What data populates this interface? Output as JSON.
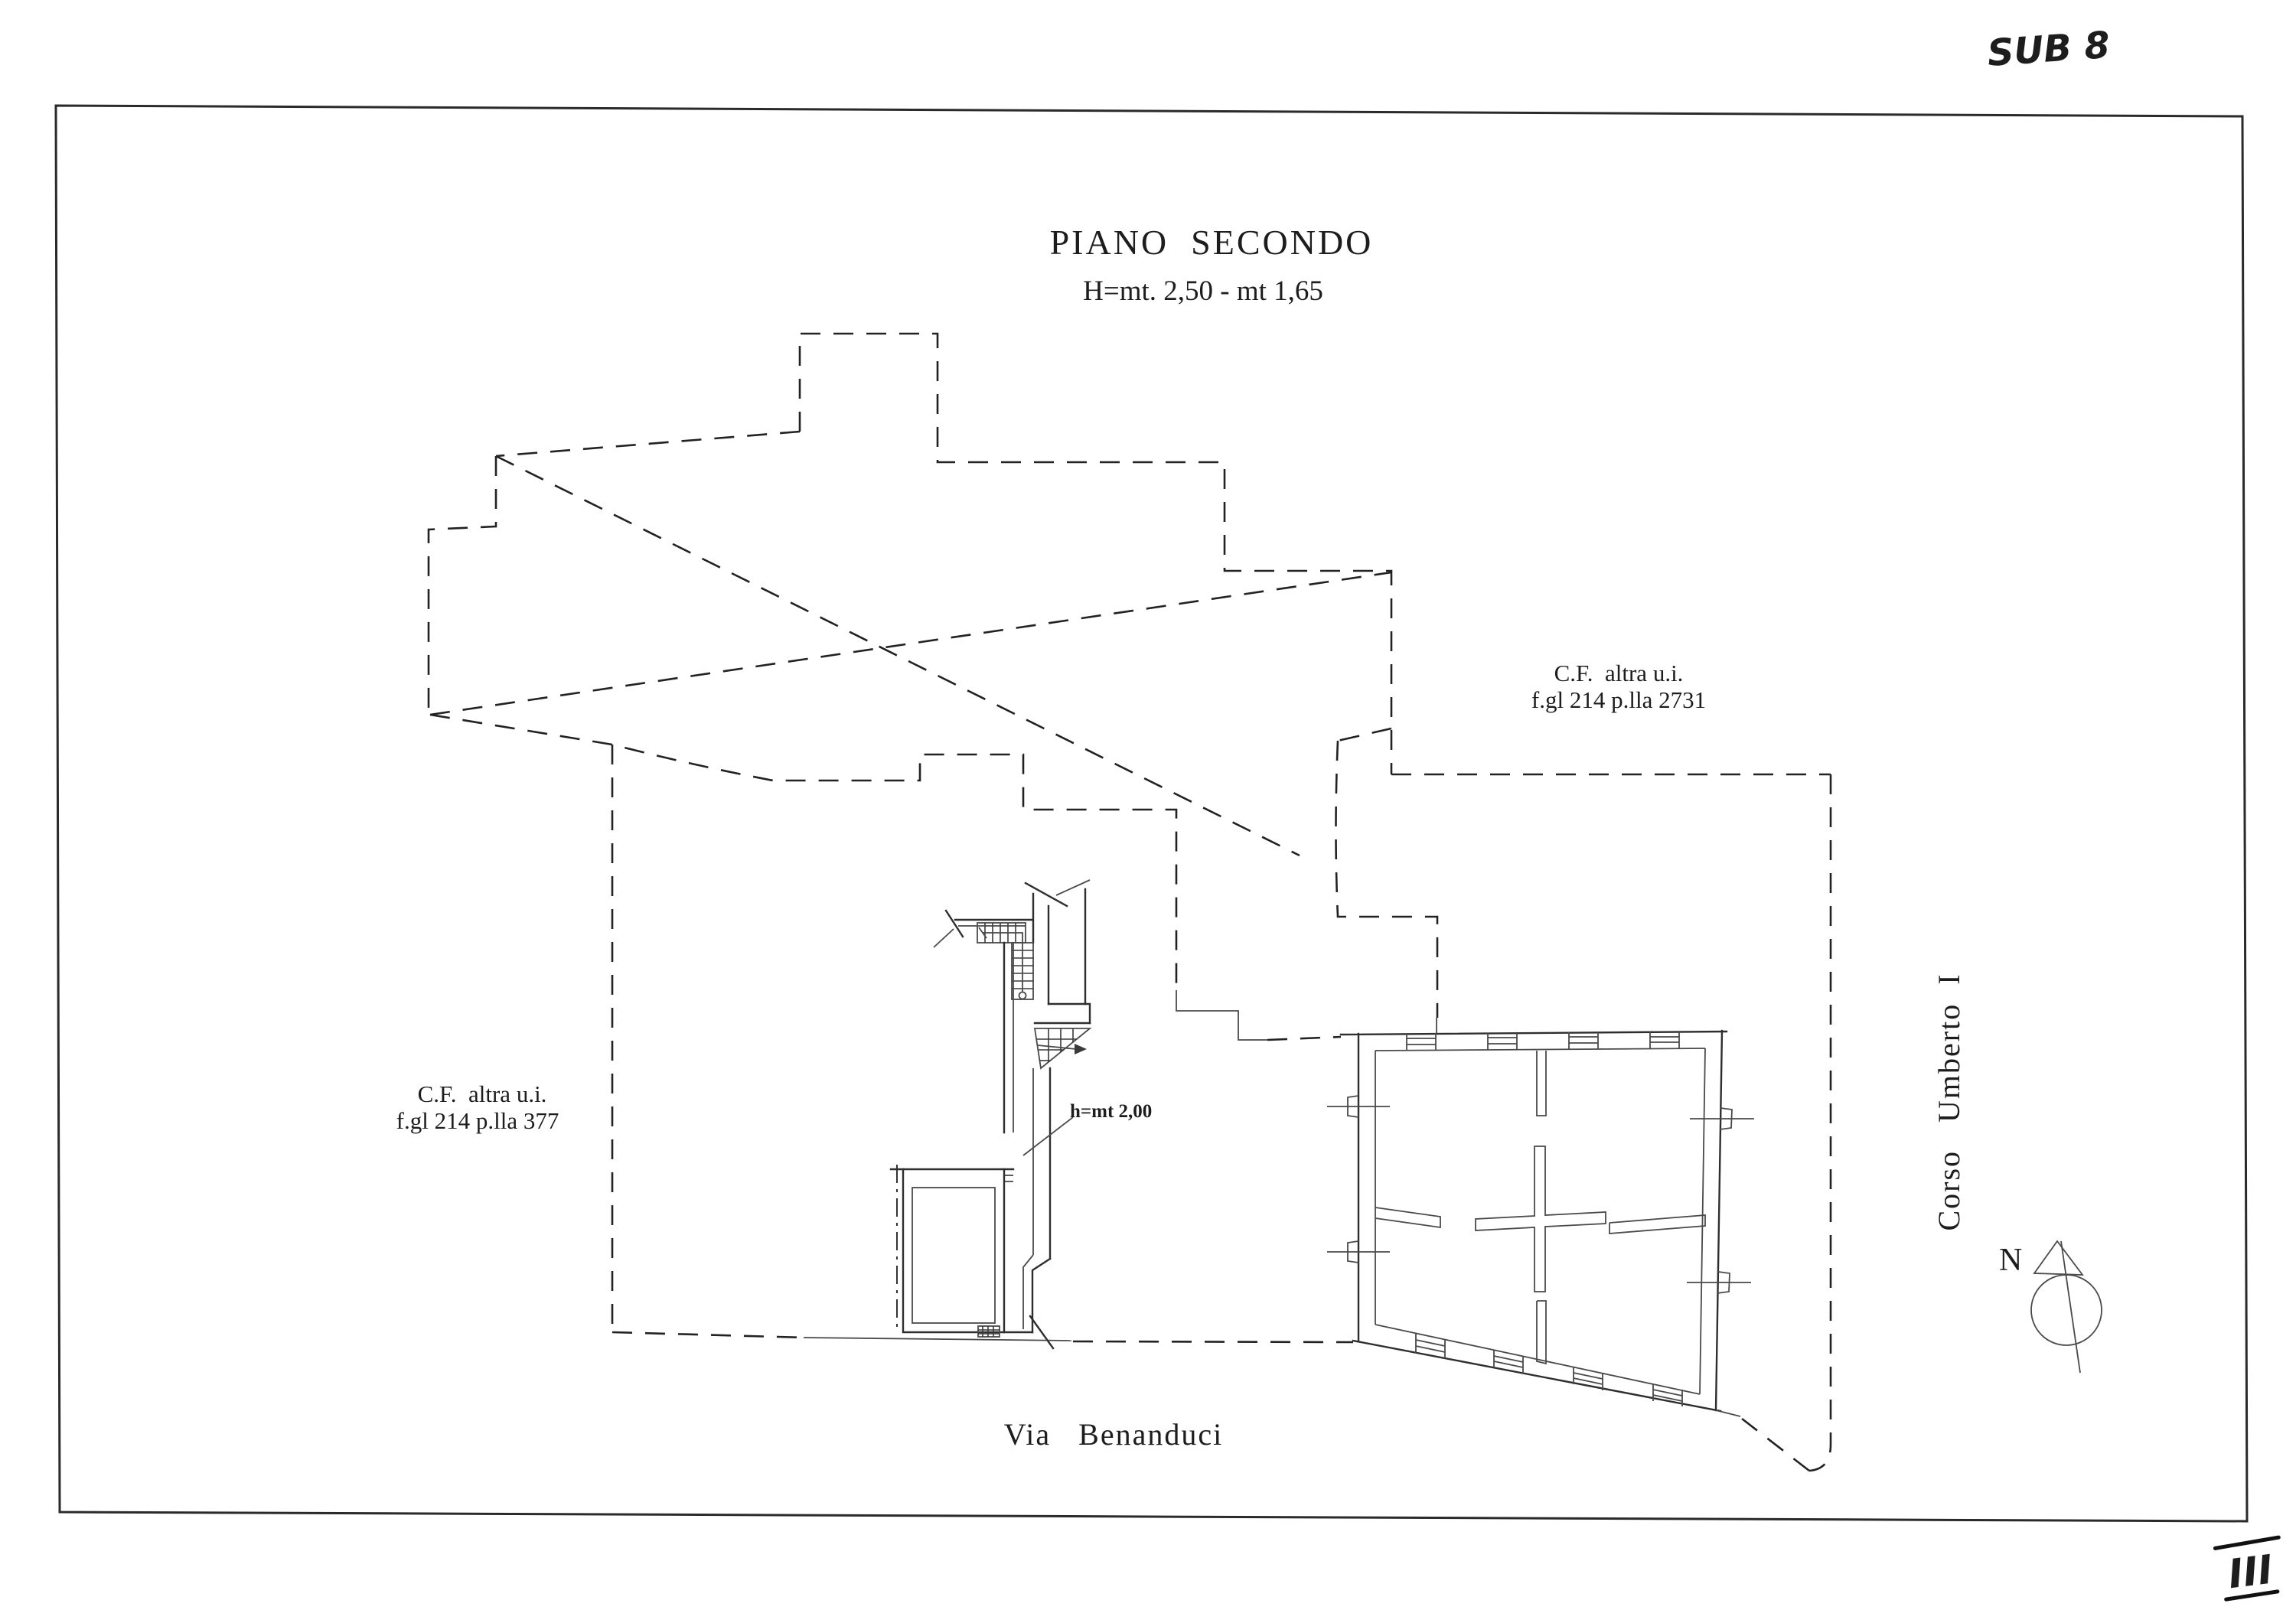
{
  "sheet": {
    "background": "#ffffff",
    "ink": "#2e2e2e"
  },
  "handwritten": {
    "sub_note": "SUB 8",
    "page_mark": "III"
  },
  "plan": {
    "title": "PIANO  SECONDO",
    "height_note": "H=mt. 2,50 - mt 1,65"
  },
  "labels": {
    "cf_right": {
      "line1": "C.F.  altra u.i.",
      "line2": "f.gl 214 p.lla 2731"
    },
    "cf_left": {
      "line1": "C.F.  altra u.i.",
      "line2": "f.gl 214 p.lla 377"
    },
    "street_right": "Corso   Umberto  I",
    "street_bottom": "Via   Benanduci",
    "stair_height": "h=mt 2,00",
    "north_letter": "N"
  }
}
